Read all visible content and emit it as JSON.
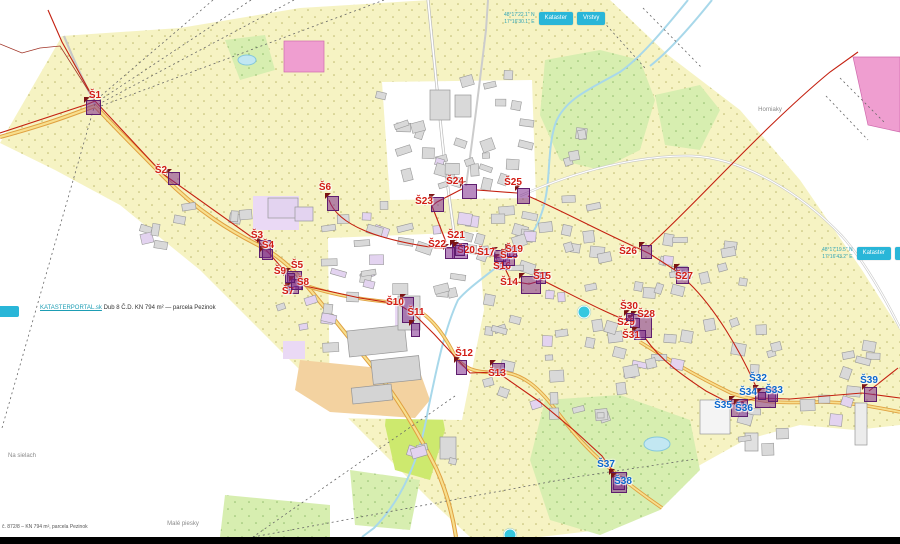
{
  "meta": {
    "app": "kataster-map",
    "town": "Pezinok"
  },
  "colors": {
    "station_red": "#d11a12",
    "station_blue": "#0a66cc",
    "marker_fill": "rgba(125,42,140,0.55)",
    "marker_border": "#5e1d6e",
    "ui_cyan": "#29b6d8",
    "road_orange": "#e0a040",
    "pipeline_red": "#c42010"
  },
  "chrome": {
    "topright": {
      "coords": [
        "48°17'22.1\" N",
        "17°16'30.1\" E"
      ],
      "buttons": [
        "Kataster",
        "Vrstvy"
      ]
    },
    "midright": {
      "coords": [
        "48°17'19.5\" N",
        "17°16'43.2\" E"
      ],
      "buttons": [
        "Kataster",
        "Vrstvy"
      ]
    },
    "left_stub_label": "«",
    "measure": {
      "link": "KATASTERPORTAL.sk",
      "text": "Dub 8 Č.D. KN 794 m² — parcela Pezinok"
    },
    "attribution": "č. 872/8 – KN 794 m², parcela Pezinok"
  },
  "place_labels": [
    {
      "text": "Horniaky",
      "x": 770,
      "y": 110
    },
    {
      "text": "Na sielach",
      "x": 22,
      "y": 456
    },
    {
      "text": "Malé piesky",
      "x": 183,
      "y": 524
    }
  ],
  "poi_dots": [
    {
      "x": 584,
      "y": 312
    },
    {
      "x": 510,
      "y": 535
    }
  ],
  "stations": [
    {
      "id": "S1",
      "label": "Š1",
      "color": "red",
      "x": 95,
      "y": 96,
      "mx": 86,
      "my": 100,
      "mw": 15,
      "mh": 15
    },
    {
      "id": "S2",
      "label": "Š2",
      "color": "red",
      "x": 161,
      "y": 171,
      "mx": 168,
      "my": 172,
      "mw": 12,
      "mh": 13
    },
    {
      "id": "S3",
      "label": "Š3",
      "color": "red",
      "x": 257,
      "y": 236,
      "mx": 259,
      "my": 240,
      "mw": 12,
      "mh": 18
    },
    {
      "id": "S4",
      "label": "Š4",
      "color": "red",
      "x": 268,
      "y": 246,
      "mx": 262,
      "my": 249,
      "mw": 11,
      "mh": 11
    },
    {
      "id": "S5",
      "label": "Š5",
      "color": "red",
      "x": 297,
      "y": 266,
      "mx": 287,
      "my": 271,
      "mw": 15,
      "mh": 19
    },
    {
      "id": "S6",
      "label": "Š6",
      "color": "red",
      "x": 325,
      "y": 188,
      "mx": 327,
      "my": 196,
      "mw": 12,
      "mh": 15
    },
    {
      "id": "S7",
      "label": "Š7",
      "color": "red",
      "x": 288,
      "y": 292,
      "mx": 287,
      "my": 286,
      "mw": 12,
      "mh": 8
    },
    {
      "id": "S8",
      "label": "Š8",
      "color": "red",
      "x": 303,
      "y": 283,
      "mx": 291,
      "my": 279,
      "mw": 12,
      "mh": 11
    },
    {
      "id": "S9",
      "label": "Š9",
      "color": "red",
      "x": 280,
      "y": 272,
      "mx": 285,
      "my": 273,
      "mw": 10,
      "mh": 10
    },
    {
      "id": "S10",
      "label": "Š10",
      "color": "red",
      "x": 395,
      "y": 303,
      "mx": 402,
      "my": 297,
      "mw": 12,
      "mh": 26
    },
    {
      "id": "S11",
      "label": "Š11",
      "color": "red",
      "x": 416,
      "y": 313,
      "mx": 411,
      "my": 323,
      "mw": 9,
      "mh": 14
    },
    {
      "id": "S12",
      "label": "Š12",
      "color": "red",
      "x": 464,
      "y": 354,
      "mx": 456,
      "my": 360,
      "mw": 11,
      "mh": 15
    },
    {
      "id": "S13",
      "label": "Š13",
      "color": "red",
      "x": 497,
      "y": 374,
      "mx": 492,
      "my": 363,
      "mw": 13,
      "mh": 10
    },
    {
      "id": "S14",
      "label": "Š14",
      "color": "red",
      "x": 509,
      "y": 283,
      "mx": 521,
      "my": 276,
      "mw": 20,
      "mh": 18
    },
    {
      "id": "S15",
      "label": "Š15",
      "color": "red",
      "x": 542,
      "y": 277,
      "mx": 536,
      "my": 272,
      "mw": 10,
      "mh": 12
    },
    {
      "id": "S16",
      "label": "Š16",
      "color": "red",
      "x": 502,
      "y": 267,
      "mx": 496,
      "my": 257,
      "mw": 14,
      "mh": 13
    },
    {
      "id": "S17",
      "label": "Š17",
      "color": "red",
      "x": 486,
      "y": 253,
      "mx": 494,
      "my": 250,
      "mw": 12,
      "mh": 12
    },
    {
      "id": "S18",
      "label": "Š18",
      "color": "red",
      "x": 509,
      "y": 256,
      "mx": 503,
      "my": 252,
      "mw": 12,
      "mh": 14
    },
    {
      "id": "S19",
      "label": "Š19",
      "color": "red",
      "x": 514,
      "y": 250,
      "mx": 507,
      "my": 247,
      "mw": 10,
      "mh": 10
    },
    {
      "id": "S20",
      "label": "Š20",
      "color": "red",
      "x": 466,
      "y": 251,
      "mx": 452,
      "my": 243,
      "mw": 16,
      "mh": 16
    },
    {
      "id": "S21",
      "label": "Š21",
      "color": "red",
      "x": 456,
      "y": 236,
      "mx": 455,
      "my": 245,
      "mw": 10,
      "mh": 11
    },
    {
      "id": "S22",
      "label": "Š22",
      "color": "red",
      "x": 437,
      "y": 245,
      "mx": 445,
      "my": 247,
      "mw": 10,
      "mh": 12
    },
    {
      "id": "S23",
      "label": "Š23",
      "color": "red",
      "x": 424,
      "y": 202,
      "mx": 431,
      "my": 197,
      "mw": 13,
      "mh": 15
    },
    {
      "id": "S24",
      "label": "Š24",
      "color": "red",
      "x": 455,
      "y": 182,
      "mx": 462,
      "my": 184,
      "mw": 15,
      "mh": 15
    },
    {
      "id": "S25",
      "label": "Š25",
      "color": "red",
      "x": 513,
      "y": 183,
      "mx": 517,
      "my": 188,
      "mw": 13,
      "mh": 16
    },
    {
      "id": "S26",
      "label": "Š26",
      "color": "red",
      "x": 628,
      "y": 252,
      "mx": 641,
      "my": 245,
      "mw": 11,
      "mh": 14
    },
    {
      "id": "S27",
      "label": "Š27",
      "color": "red",
      "x": 684,
      "y": 277,
      "mx": 676,
      "my": 267,
      "mw": 13,
      "mh": 17
    },
    {
      "id": "S28",
      "label": "Š28",
      "color": "red",
      "x": 646,
      "y": 315,
      "mx": 633,
      "my": 314,
      "mw": 19,
      "mh": 24
    },
    {
      "id": "S29",
      "label": "Š29",
      "color": "red",
      "x": 626,
      "y": 323,
      "mx": 630,
      "my": 318,
      "mw": 10,
      "mh": 10
    },
    {
      "id": "S30",
      "label": "Š30",
      "color": "red",
      "x": 629,
      "y": 307,
      "mx": 626,
      "my": 313,
      "mw": 8,
      "mh": 8
    },
    {
      "id": "S31",
      "label": "Š31",
      "color": "red",
      "x": 631,
      "y": 336,
      "mx": 634,
      "my": 330,
      "mw": 12,
      "mh": 10
    },
    {
      "id": "S32",
      "label": "Š32",
      "color": "blue",
      "x": 758,
      "y": 379,
      "mx": 755,
      "my": 388,
      "mw": 21,
      "mh": 20
    },
    {
      "id": "S33",
      "label": "Š33",
      "color": "blue",
      "x": 774,
      "y": 391,
      "mx": 768,
      "my": 390,
      "mw": 10,
      "mh": 12
    },
    {
      "id": "S34",
      "label": "Š34",
      "color": "blue",
      "x": 748,
      "y": 393,
      "mx": 758,
      "my": 392,
      "mw": 8,
      "mh": 8
    },
    {
      "id": "S35",
      "label": "Š35",
      "color": "blue",
      "x": 723,
      "y": 406,
      "mx": 731,
      "my": 399,
      "mw": 17,
      "mh": 18
    },
    {
      "id": "S36",
      "label": "Š36",
      "color": "blue",
      "x": 744,
      "y": 409,
      "mx": 736,
      "my": 402,
      "mw": 8,
      "mh": 8
    },
    {
      "id": "S37",
      "label": "Š37",
      "color": "blue",
      "x": 606,
      "y": 465,
      "mx": 611,
      "my": 472,
      "mw": 16,
      "mh": 21
    },
    {
      "id": "S38",
      "label": "Š38",
      "color": "blue",
      "x": 623,
      "y": 482,
      "mx": 613,
      "my": 476,
      "mw": 12,
      "mh": 14
    },
    {
      "id": "S39",
      "label": "Š39",
      "color": "blue",
      "x": 869,
      "y": 381,
      "mx": 864,
      "my": 387,
      "mw": 13,
      "mh": 15
    }
  ]
}
